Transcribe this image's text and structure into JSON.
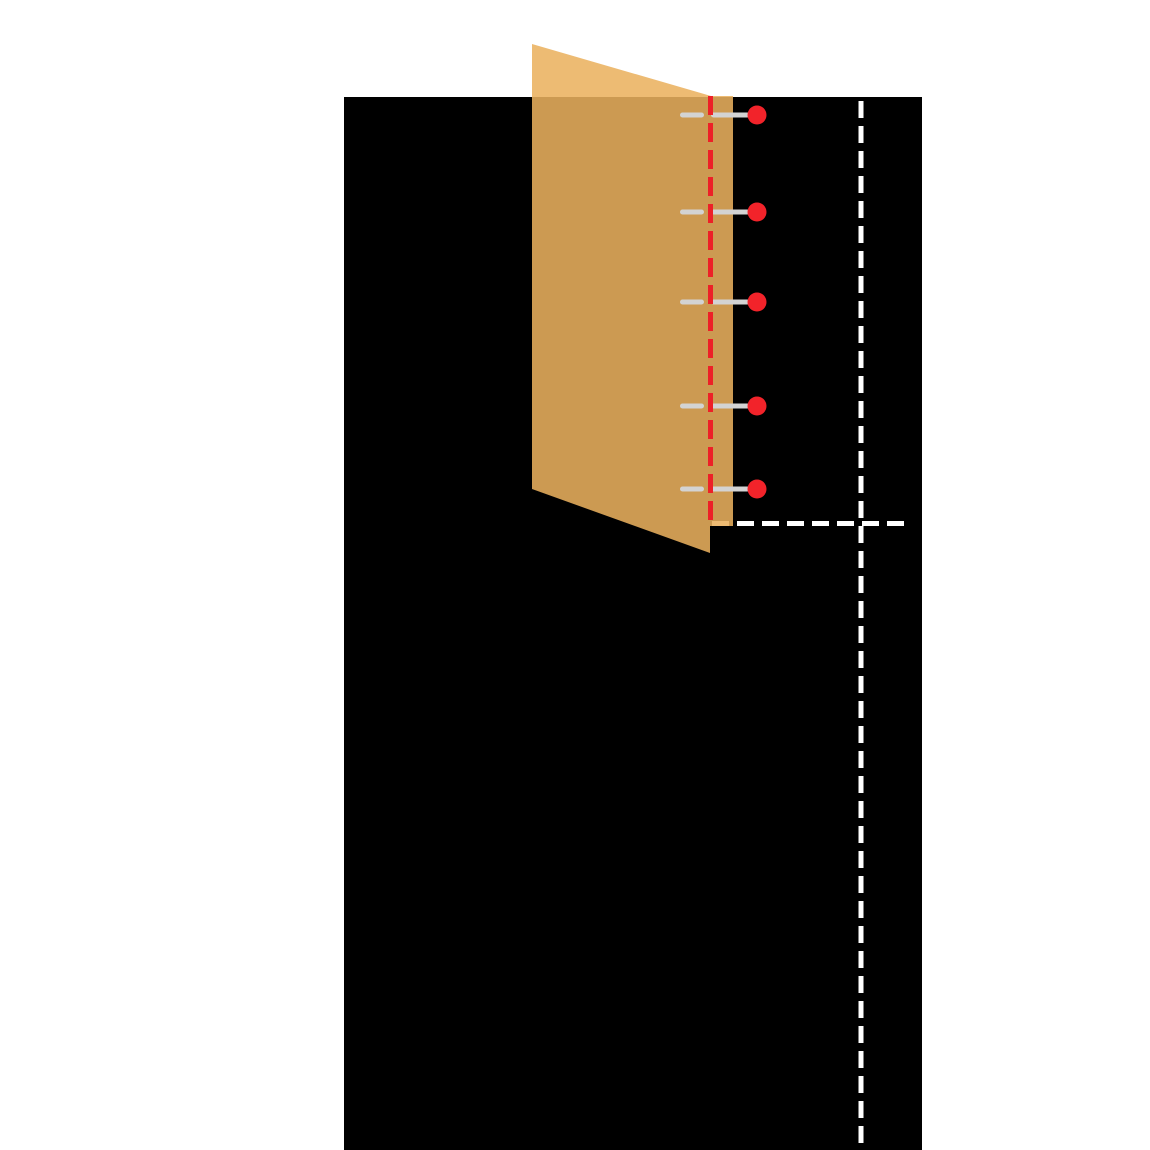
{
  "page": {
    "background_color": "#ffffff",
    "canvas": {
      "width": 1150,
      "height": 1150
    }
  },
  "diagram": {
    "description": "Quilt binding strip pinned to panel edge with stitch line and corner guide lines",
    "quilt_panel": {
      "color": "#000000",
      "x": 344,
      "y": 97,
      "width": 578,
      "height": 1053
    },
    "fabric_strip": {
      "color": "#EAB15E",
      "opacity": 0.87,
      "points": "532,44 711,96 733,96 733,526 710,526 710,553 532,489"
    },
    "stitch_line": {
      "color": "#ED2027",
      "x": 710.5,
      "y1": 96,
      "y2": 528,
      "width": 5,
      "dash": "19 8"
    },
    "guide_line_vertical": {
      "color": "#FFFFFF",
      "x": 861,
      "y1": 101,
      "y2": 1150,
      "width": 5,
      "dash": "17 8"
    },
    "guide_line_horizontal": {
      "color": "#FFFFFF",
      "y": 523.5,
      "x1": 712,
      "x2": 905,
      "width": 5,
      "dash": "17 8"
    },
    "pins": {
      "shaft_color": "#D3D3D3",
      "head_color": "#F2232A",
      "head_radius": 9.5,
      "head_cx": 757,
      "shaft_thickness": 5,
      "tip_x1": 680,
      "tip_x2": 704,
      "shaft_x1": 711,
      "shaft_x2": 750,
      "y_positions": [
        115,
        212,
        302,
        406,
        489
      ]
    }
  }
}
